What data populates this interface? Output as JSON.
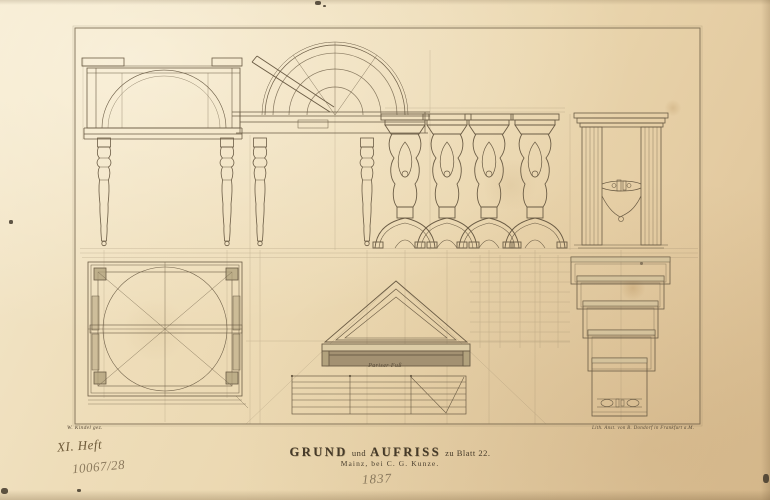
{
  "plate": {
    "artist_credit": "W. Kindel gez.",
    "lithographer_credit": "Lith. Anst. von B. Dondorf in Frankfurt a.M.",
    "title_word1": "GRUND",
    "title_conj": "und",
    "title_word2": "AUFRISS",
    "title_rest": "zu Blatt 22.",
    "imprint": "Mainz, bei C. G. Kunze.",
    "scale_label": "Pariser Fuß"
  },
  "annotations": {
    "heft_note": "XI. Heft",
    "inventory_number": "10067/28",
    "year_note": "1837"
  },
  "colors": {
    "paper": "#ead6ae",
    "ink_line": "#6b5c45",
    "construction_line": "#8a7a5f",
    "printed_text": "#453a29",
    "handwriting_ink": "#6e5a39",
    "pencil": "#8a795d",
    "shade_fill": "#a39172"
  }
}
